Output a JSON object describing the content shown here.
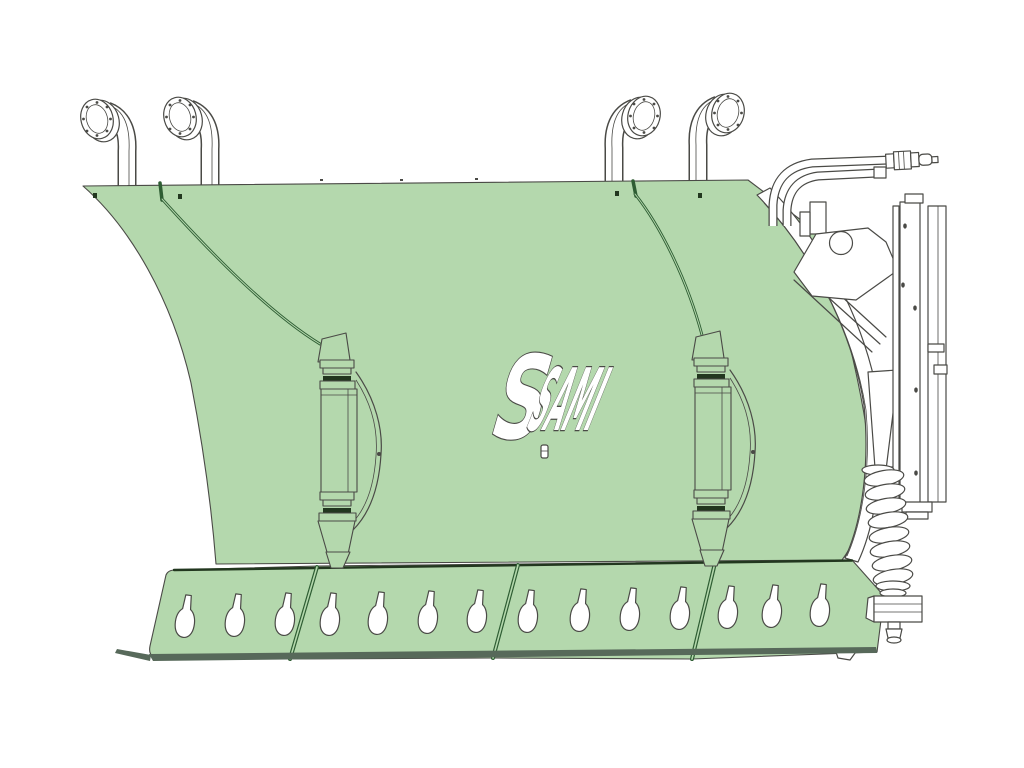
{
  "illustration": {
    "alt": "Technical line rendering of a SAMI snow plough blade: pale green curved moldboard with four spring-trip posts on top, two vertical support ribs, a four-segment bolt-on cutting edge with teardrop bolt slots, and a rear mounting frame with hydraulic hoses, quick coupler and trip spring"
  },
  "logo": {
    "mark": "S",
    "brand": "SAMI"
  },
  "colors": {
    "background": "#ffffff",
    "green": "#b4d8ad",
    "seam": "#2e5d33",
    "line": "#4a4a46",
    "dark": "#22371f",
    "shadow": "#57695a",
    "white": "#ffffff"
  }
}
